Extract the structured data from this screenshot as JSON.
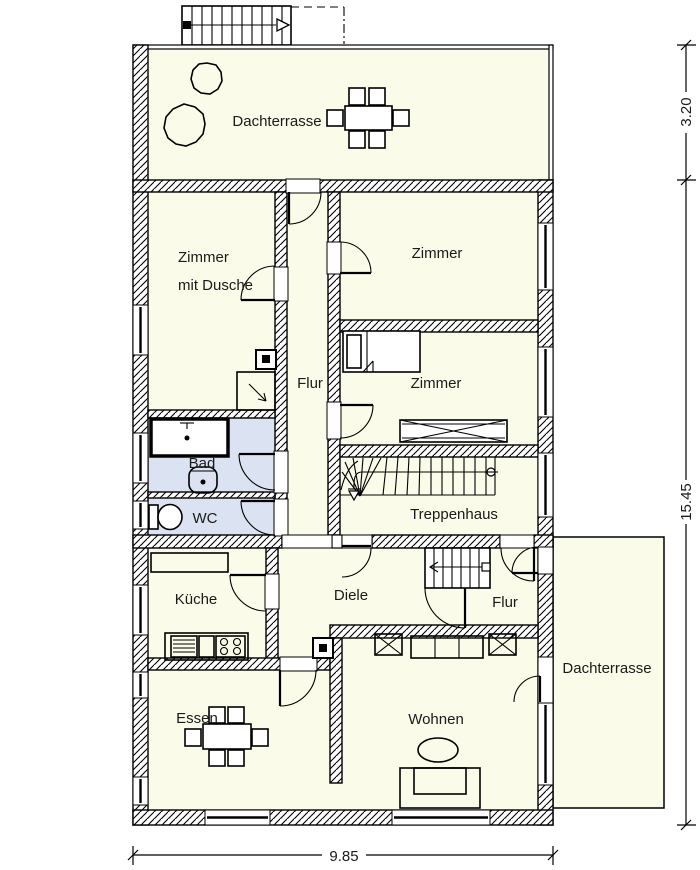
{
  "rooms": {
    "dachterrasse_top": {
      "label": "Dachterrasse"
    },
    "zimmer_mit_dusche": {
      "label_line1": "Zimmer",
      "label_line2": "mit Dusche"
    },
    "zimmer_top": {
      "label": "Zimmer"
    },
    "zimmer_mid": {
      "label": "Zimmer"
    },
    "flur_upper": {
      "label": "Flur"
    },
    "bad": {
      "label": "Bad"
    },
    "wc": {
      "label": "WC"
    },
    "treppenhaus": {
      "label": "Treppenhaus"
    },
    "kueche": {
      "label": "Küche"
    },
    "diele": {
      "label": "Diele"
    },
    "flur_lower": {
      "label": "Flur"
    },
    "essen": {
      "label": "Essen"
    },
    "wohnen": {
      "label": "Wohnen"
    },
    "dachterrasse_right": {
      "label": "Dachterrasse"
    }
  },
  "dimensions": {
    "terrace_depth_m": "3.20",
    "building_length_m": "15.45",
    "building_width_m": "9.85"
  },
  "colors": {
    "floor": "#fbfbe9",
    "wet_floor": "#dbe2f2",
    "line": "#000000",
    "background": "#ffffff"
  }
}
